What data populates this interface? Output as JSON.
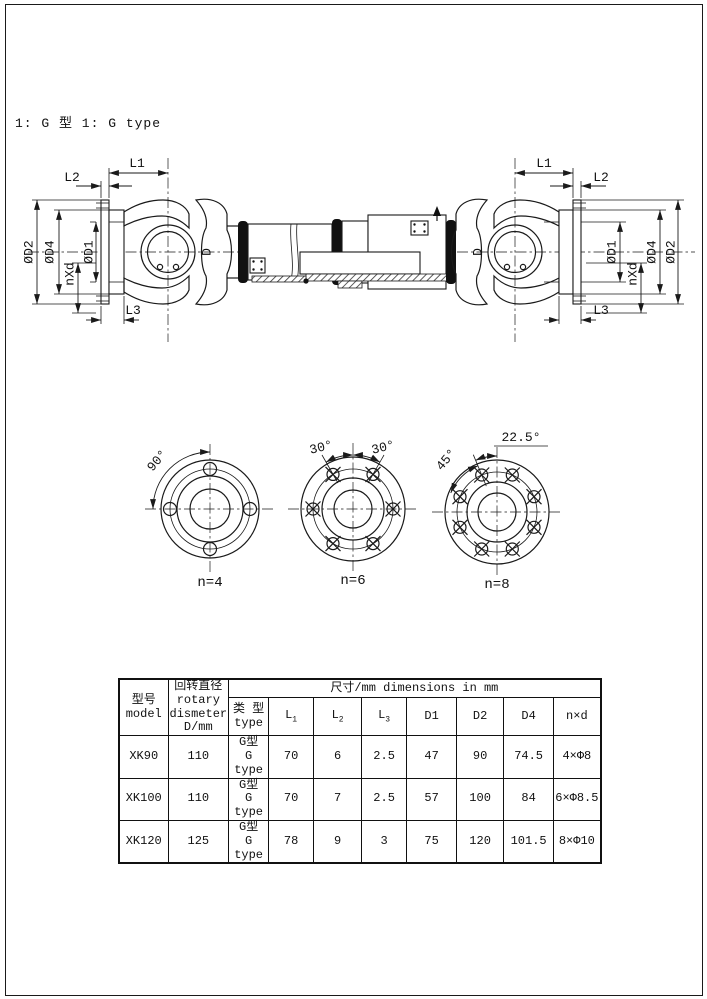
{
  "page": {
    "note": "1: G 型 1: G type"
  },
  "drawing": {
    "labels": {
      "l1": "L1",
      "l2": "L2",
      "l3": "L3",
      "d2": "ØD2",
      "d4": "ØD4",
      "nxd": "nXd",
      "d1": "ØD1",
      "d": "D"
    }
  },
  "views": [
    {
      "name": "n=4",
      "a1": "90°"
    },
    {
      "name": "n=6",
      "a1": "30°",
      "a2": "30°"
    },
    {
      "name": "n=8",
      "a1": "45°",
      "a2": "22.5°"
    }
  ],
  "table": {
    "span": "尺寸/mm  dimensions in mm",
    "model_zh": "型号",
    "model_en": "model",
    "rotary1": "回转直径",
    "rotary2": "rotary",
    "rotary3": "dismeter",
    "rotary4": "D/mm",
    "type_zh": "类 型",
    "type_en": "type",
    "lbase": "L",
    "l1sub": "1",
    "l2sub": "2",
    "l3sub": "3",
    "d1": "D1",
    "d2": "D2",
    "d4": "D4",
    "nxd": "n×d",
    "rows": [
      {
        "model": "XK90",
        "rotary": "110",
        "type_zh": "G型",
        "type_en": "G type",
        "l1": "70",
        "l2": "6",
        "l3": "2.5",
        "d1": "47",
        "d2": "90",
        "d4": "74.5",
        "nxd": "4×Φ8"
      },
      {
        "model": "XK100",
        "rotary": "110",
        "type_zh": "G型",
        "type_en": "G type",
        "l1": "70",
        "l2": "7",
        "l3": "2.5",
        "d1": "57",
        "d2": "100",
        "d4": "84",
        "nxd": "6×Φ8.5"
      },
      {
        "model": "XK120",
        "rotary": "125",
        "type_zh": "G型",
        "type_en": "G type",
        "l1": "78",
        "l2": "9",
        "l3": "3",
        "d1": "75",
        "d2": "120",
        "d4": "101.5",
        "nxd": "8×Φ10"
      }
    ]
  }
}
